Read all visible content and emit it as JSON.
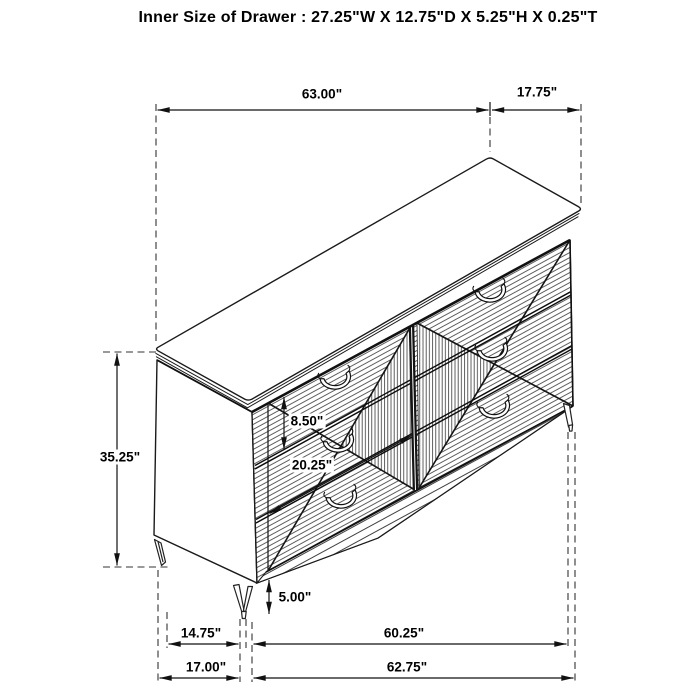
{
  "title": "Inner Size of Drawer : 27.25\"W X 12.75\"D X 5.25\"H X 0.25\"T",
  "dimensions": {
    "top_width": "63.00\"",
    "top_depth": "17.75\"",
    "overall_height": "35.25\"",
    "drawer_front_height": "8.50\"",
    "drawer_width": "20.25\"",
    "leg_height": "5.00\"",
    "base_side_depth": "14.75\"",
    "base_front_width": "60.25\"",
    "floor_side_depth": "17.00\"",
    "floor_front_width": "62.75\""
  },
  "figure": {
    "type": "isometric-line-drawing",
    "subject": "6-drawer dresser",
    "line_color": "#111111",
    "background": "#ffffff"
  }
}
